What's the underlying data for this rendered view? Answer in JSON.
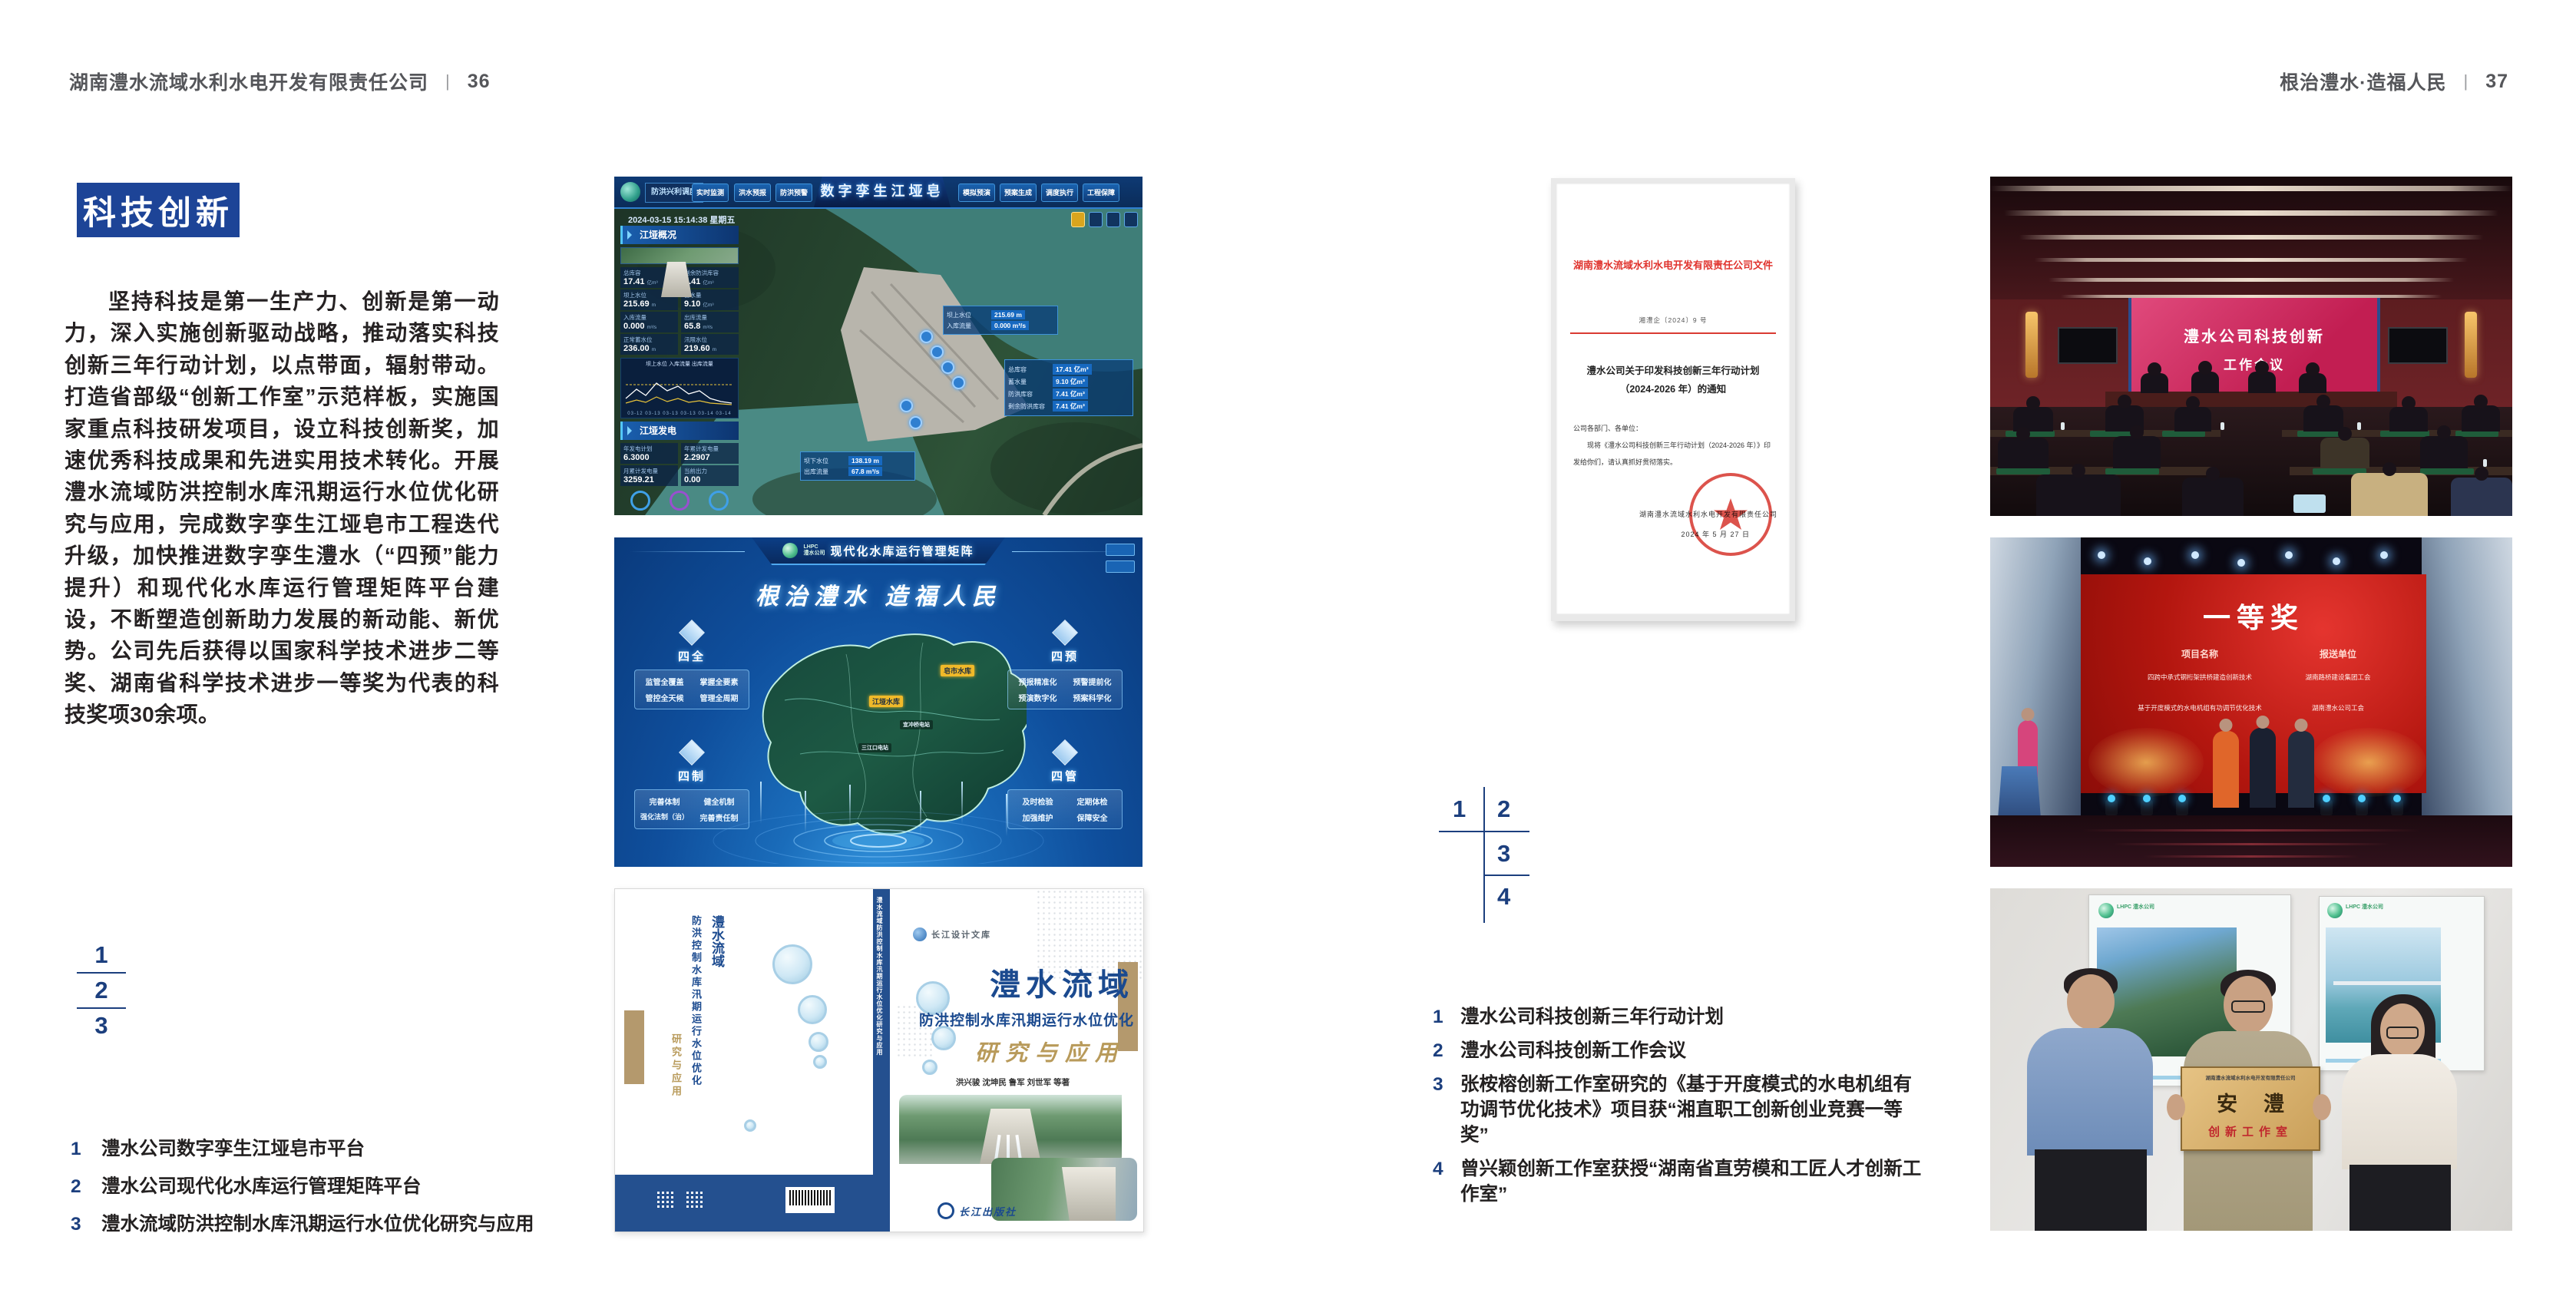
{
  "page_left": {
    "header": {
      "company": "湖南澧水流域水利水电开发有限责任公司",
      "separator": "|",
      "page_number": "36"
    },
    "badge": "科技创新",
    "body_paragraph": "坚持科技是第一生产力、创新是第一动力，深入实施创新驱动战略，推动落实科技创新三年行动计划，以点带面，辐射带动。打造省部级“创新工作室”示范样板，实施国家重点科技研发项目，设立科技创新奖，加速优秀科技成果和先进实用技术转化。开展澧水流域防洪控制水库汛期运行水位优化研究与应用，完成数字孪生江垭皂市工程迭代升级，加快推进数字孪生澧水（“四预”能力提升）和现代化水库运行管理矩阵平台建设，不断塑造创新助力发展的新动能、新优势。公司先后获得以国家科学技术进步二等奖、湖南省科学技术进步一等奖为代表的科技奖项30余项。",
    "figure_index": {
      "n1": "1",
      "n2": "2",
      "n3": "3"
    },
    "captions": [
      {
        "num": "1",
        "text": "澧水公司数字孪生江垭皂市平台"
      },
      {
        "num": "2",
        "text": "澧水公司现代化水库运行管理矩阵平台"
      },
      {
        "num": "3",
        "text": "澧水流域防洪控制水库汛期运行水位优化研究与应用"
      }
    ],
    "fig_digital_twin": {
      "title": "数字孪生江垭皂市",
      "module": "防洪兴利调度",
      "tabs_left": [
        "实时监测",
        "洪水预报",
        "防洪预警"
      ],
      "tabs_right": [
        "模拟预演",
        "预案生成",
        "调度执行",
        "工程保障"
      ],
      "timestamp": "2024-03-15 15:14:38 星期五",
      "panel_overview_title": "江垭概况",
      "panel_power_title": "江垭发电",
      "stats": [
        {
          "label": "总库容",
          "value": "17.41",
          "unit": "亿m³"
        },
        {
          "label": "剩余防洪库容",
          "value": "7.41",
          "unit": "亿m³"
        },
        {
          "label": "坝上水位",
          "value": "215.69",
          "unit": "m"
        },
        {
          "label": "蓄水量",
          "value": "9.10",
          "unit": "亿m³"
        },
        {
          "label": "入库流量",
          "value": "0.000",
          "unit": "m³/s"
        },
        {
          "label": "出库流量",
          "value": "65.8",
          "unit": "m³/s"
        },
        {
          "label": "正常蓄水位",
          "value": "236.00",
          "unit": "m"
        },
        {
          "label": "汛限水位",
          "value": "219.60",
          "unit": "m"
        }
      ],
      "chart_legend": "坝上水位  入库流量  出库流量",
      "chart_xticks": "03-12  03-13  03-13  03-13  03-14  03-14",
      "power_stats": [
        {
          "label": "年发电计划",
          "value": "6.3000"
        },
        {
          "label": "年累计发电量",
          "value": "2.2907"
        },
        {
          "label": "月累计发电量",
          "value": "3259.21"
        },
        {
          "label": "当前出力",
          "value": "0.00"
        }
      ],
      "tag_upstream": {
        "label": "坝上水位",
        "value": "215.69 m",
        "label2": "入库流量",
        "value2": "0.000 m³/s"
      },
      "tag_capacity": [
        {
          "label": "总库容",
          "value": "17.41 亿m³"
        },
        {
          "label": "蓄水量",
          "value": "9.10 亿m³"
        },
        {
          "label": "防洪库容",
          "value": "7.41 亿m³"
        },
        {
          "label": "剩余防洪库容",
          "value": "7.41 亿m³"
        }
      ],
      "tag_downstream": {
        "label": "坝下水位",
        "value": "138.19 m",
        "label2": "出库流量",
        "value2": "67.8 m³/s"
      }
    },
    "fig_matrix": {
      "logo_abbr": "LHPC",
      "logo_name": "澧水公司",
      "title": "现代化水库运行管理矩阵",
      "slogan": "根治澧水 造福人民",
      "groups": [
        {
          "name": "四全",
          "items": [
            "监管全覆盖",
            "掌握全要素",
            "管控全天候",
            "管理全周期"
          ]
        },
        {
          "name": "四预",
          "items": [
            "预报精准化",
            "预警提前化",
            "预演数字化",
            "预案科学化"
          ]
        },
        {
          "name": "四制",
          "items": [
            "完善体制",
            "健全机制",
            "强化法制（治）",
            "完善责任制"
          ]
        },
        {
          "name": "四管",
          "items": [
            "及时检验",
            "定期体检",
            "加强维护",
            "保障安全"
          ]
        }
      ],
      "map_labels": [
        {
          "text": "皂市水库"
        },
        {
          "text": "江垭水库"
        },
        {
          "text": "宜冲桥电站"
        },
        {
          "text": "三江口电站"
        }
      ]
    },
    "fig_book": {
      "series_badge": "长江设计文库",
      "title_main": "澧水流域",
      "title_sub": "防洪控制水库汛期运行水位优化",
      "title_tail": "研究与应用",
      "authors": "洪兴骏  沈坤民  鲁军  刘世军  等著",
      "publisher": "长江出版社",
      "spine_text": "澧水流域防洪控制水库汛期运行水位优化研究与应用",
      "back_title_v1": "澧水流域",
      "back_title_v2": "防洪控制水库汛期运行水位优化",
      "back_title_v3": "研究与应用"
    }
  },
  "page_right": {
    "header": {
      "motto": "根治澧水·造福人民",
      "separator": "|",
      "page_number": "37"
    },
    "document": {
      "red_header": "湖南澧水流域水利水电开发有限责任公司文件",
      "doc_no": "湘澧企〔2024〕9 号",
      "title_line1": "澧水公司关于印发科技创新三年行动计划",
      "title_line2": "（2024-2026 年）的通知",
      "salutation": "公司各部门、各单位：",
      "body": "现将《澧水公司科技创新三年行动计划（2024-2026 年）》印发给你们，请认真抓好贯彻落实。",
      "signer": "湖南澧水流域水利水电开发有限责任公司",
      "date": "2024 年 5 月 27 日"
    },
    "figure_index": {
      "n1": "1",
      "n2": "2",
      "n3": "3",
      "n4": "4"
    },
    "captions": [
      {
        "num": "1",
        "text": "澧水公司科技创新三年行动计划"
      },
      {
        "num": "2",
        "text": "澧水公司科技创新工作会议"
      },
      {
        "num": "3",
        "text": "张桉榕创新工作室研究的《基于开度模式的水电机组有功调节优化技术》项目获“湘直职工创新创业竞赛一等奖”"
      },
      {
        "num": "4",
        "text": "曾兴颖创新工作室获授“湖南省直劳模和工匠人才创新工作室”"
      }
    ],
    "photo_meeting": {
      "screen_line1": "澧水公司科技创新",
      "screen_line2": "工作会议"
    },
    "photo_award": {
      "award_title": "一等奖",
      "col_project": "项目名称",
      "col_unit": "报送单位",
      "rows": [
        {
          "project": "四跨中承式钢桁架拱桥建造创新技术",
          "unit": "湖南路桥建设集团工会"
        },
        {
          "project": "基于开度模式的水电机组有功调节优化技术",
          "unit": "湖南澧水公司工会"
        }
      ]
    },
    "photo_plaque": {
      "plaque_org": "湖南澧水流域水利水电开发有限责任公司",
      "plaque_title": "安澧",
      "plaque_sub": "创新工作室",
      "poster_logo": "LHPC 澧水公司"
    }
  },
  "colors": {
    "accent_blue": "#1d4497",
    "index_navy": "#1c3f7e",
    "doc_red": "#e0332d",
    "gold": "#b89a5a"
  }
}
